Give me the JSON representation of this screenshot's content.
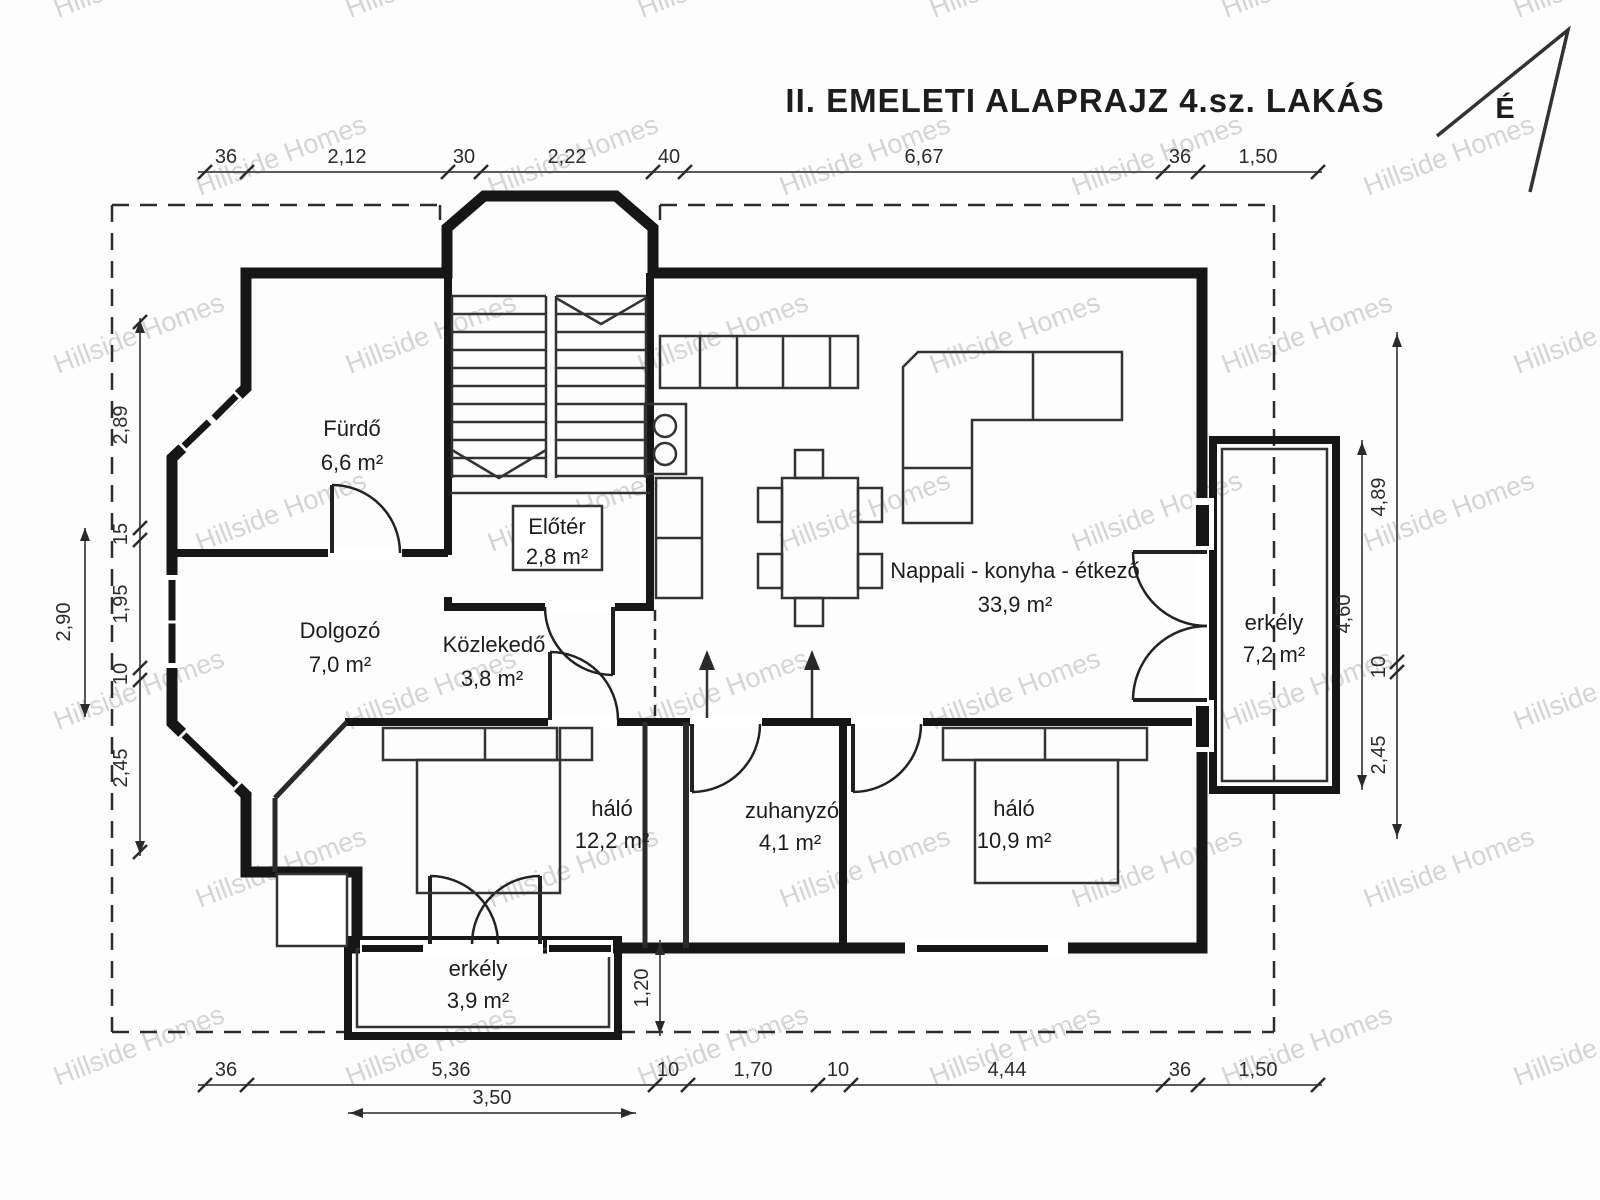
{
  "title": "II. EMELETI ALAPRAJZ  4.sz. LAKÁS",
  "north": {
    "label": "É"
  },
  "watermark": {
    "text": "Hillside Homes"
  },
  "colors": {
    "walls": "#161616",
    "dimension_text": "#2b2b2b",
    "watermark": "#9d9d9d"
  },
  "rooms": {
    "furdo": {
      "name": "Fürdő",
      "area": "6,6 m²"
    },
    "eloter": {
      "name": "Előtér",
      "area": "2,8 m²"
    },
    "dolgozo": {
      "name": "Dolgozó",
      "area": "7,0 m²"
    },
    "kozlekedo": {
      "name": "Közlekedő",
      "area": "3,8 m²"
    },
    "nappali": {
      "name": "Nappali - konyha - étkező",
      "area": "33,9 m²"
    },
    "erkely_jobb": {
      "name": "erkély",
      "area": "7,2 m²"
    },
    "halo1": {
      "name": "háló",
      "area": "12,2 m²"
    },
    "zuhanyzo": {
      "name": "zuhanyzó",
      "area": "4,1 m²"
    },
    "halo2": {
      "name": "háló",
      "area": "10,9 m²"
    },
    "erkely_also": {
      "name": "erkély",
      "area": "3,9 m²"
    }
  },
  "dimensions": {
    "top": [
      "36",
      "2,12",
      "30",
      "2,22",
      "40",
      "6,67",
      "36",
      "1,50"
    ],
    "bottom": [
      "36",
      "5,36",
      "10",
      "1,70",
      "10",
      "4,44",
      "36",
      "1,50"
    ],
    "bottom_secondary": "3,50",
    "left_outer": "2,90",
    "left_chain": [
      "2,89",
      "15",
      "1,95",
      "10",
      "2,45"
    ],
    "right_outer_chain": [
      "4,89",
      "10",
      "2,45"
    ],
    "right_inner": "4,60",
    "balcony_depth": "1,20"
  }
}
